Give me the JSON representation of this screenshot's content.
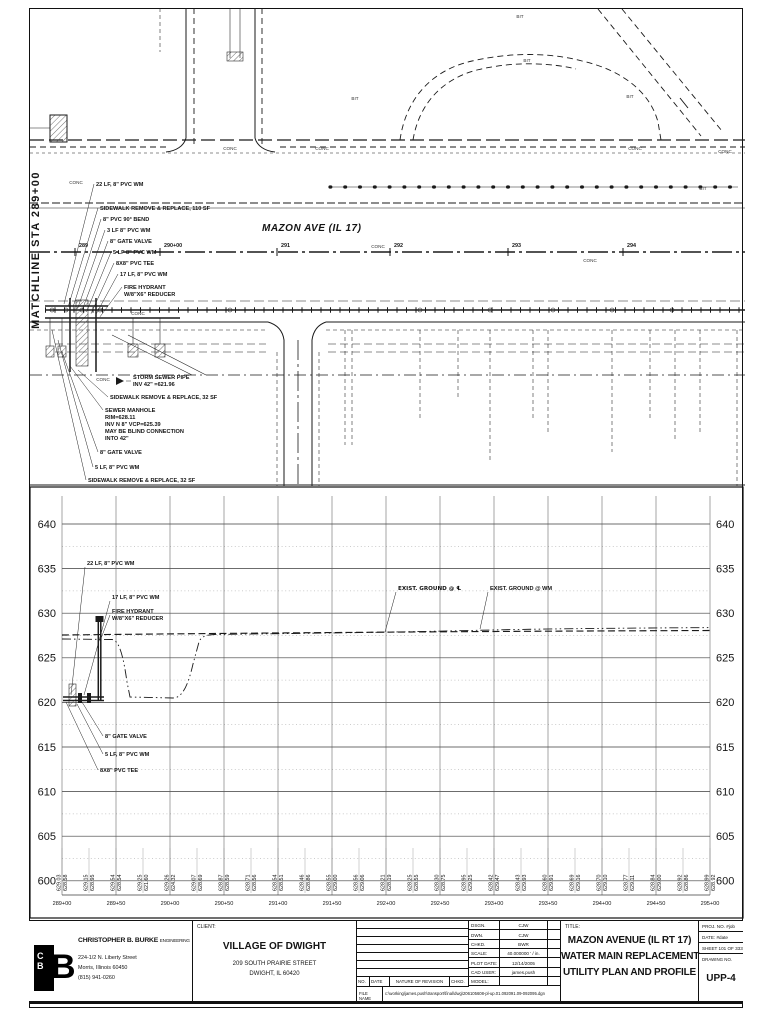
{
  "labels": {
    "conc": "CONC",
    "bit": "BIT"
  },
  "plan": {
    "matchline": "MATCHLINE STA 289+00",
    "road_name": "MAZON AVE (IL 17)",
    "stations": [
      "289",
      "290+00",
      "291",
      "292",
      "293",
      "294"
    ],
    "callouts_upper": [
      "22 LF, 8\" PVC WM",
      "SIDEWALK REMOVE & REPLACE, 110 SF",
      "8\" PVC 90° BEND",
      "3 LF 8\" PVC WM",
      "8\" GATE VALVE",
      "5 LF 8\" PVC WM",
      "8X8\" PVC TEE",
      "17 LF, 8\" PVC WM",
      [
        "FIRE HYDRANT",
        "W/8\"X6\" REDUCER"
      ]
    ],
    "callouts_lower": [
      [
        "STORM SEWER PIPE",
        "INV 42\" =621.96"
      ],
      "SIDEWALK REMOVE & REPLACE, 32 SF",
      [
        "SEWER MANHOLE",
        "RIM=628.11",
        "INV N 8\" VCP=625.39",
        "MAY BE BLIND CONNECTION",
        "INTO 42\""
      ],
      "8\" GATE VALVE",
      "5 LF, 8\" PVC WM",
      "SIDEWALK REMOVE & REPLACE, 32 SF"
    ]
  },
  "profile": {
    "elevations": [
      "640",
      "635",
      "630",
      "625",
      "620",
      "615",
      "610",
      "605",
      "600"
    ],
    "stations": [
      "289+00",
      "289+50",
      "290+00",
      "290+50",
      "291+00",
      "291+50",
      "292+00",
      "292+50",
      "293+00",
      "293+50",
      "294+00",
      "294+50",
      "295+00"
    ],
    "ground_cl": "EXIST. GROUND @ ℄",
    "ground_wm": "EXIST. GROUND @ WM",
    "callouts": [
      "22 LF, 8\" PVC WM",
      "17 LF, 8\" PVC WM",
      [
        "FIRE HYDRANT",
        "W/8\"X6\" REDUCER"
      ],
      "8\" GATE VALVE",
      "5 LF, 8\" PVC WM",
      "8X8\" PVC TEE"
    ],
    "elevation_pairs": [
      [
        "629.03",
        "628.58"
      ],
      [
        "629.15",
        "628.95"
      ],
      [
        "629.54",
        "628.54"
      ],
      [
        "629.25",
        "621.60"
      ],
      [
        "629.26",
        "624.32"
      ],
      [
        "629.07",
        "628.69"
      ],
      [
        "628.87",
        "628.59"
      ],
      [
        "628.71",
        "628.56"
      ],
      [
        "628.54",
        "628.51"
      ],
      [
        "628.46",
        "628.86"
      ],
      [
        "628.55",
        "629.00"
      ],
      [
        "628.56",
        "629.06"
      ],
      [
        "628.21",
        "628.19"
      ],
      [
        "628.25",
        "628.55"
      ],
      [
        "628.30",
        "628.75"
      ],
      [
        "628.95",
        "629.25"
      ],
      [
        "628.42",
        "629.47"
      ],
      [
        "628.43",
        "629.93"
      ],
      [
        "628.60",
        "629.91"
      ],
      [
        "628.69",
        "629.16"
      ],
      [
        "628.70",
        "629.10"
      ],
      [
        "628.77",
        "629.11"
      ],
      [
        "628.84",
        "629.00"
      ],
      [
        "628.92",
        "628.86"
      ],
      [
        "628.99",
        "628.92"
      ]
    ]
  },
  "titleblock": {
    "company": {
      "name": "CHRISTOPHER B. BURKE",
      "suffix": "ENGINEERING LTD.",
      "address1": "224-1/2 N. Liberty Street",
      "address2": "Morris, Illinois 60450",
      "phone": "(815) 941-0260",
      "logo_c": "C",
      "logo_b": "B",
      "logo_big_b": "B"
    },
    "client": {
      "label": "CLIENT:",
      "name": "VILLAGE OF DWIGHT",
      "address1": "209 SOUTH PRAIRIE STREET",
      "address2": "DWIGHT, IL 60420"
    },
    "revision": {
      "no": "NO.",
      "date": "DATE",
      "nature": "NATURE OF REVISION",
      "chkd": "CHKD.",
      "file_label": "FILE NAME",
      "file_path": "c:\\working\\james.push\\transport\\final\\dwg\\206105608-pl-up.01.092091.09-092095.dgn"
    },
    "info": {
      "dsgn_label": "DSGN.",
      "dsgn": "CJW",
      "dwn_label": "DWN.",
      "dwn": "CJW",
      "chkd_label": "CHKD.",
      "chkd": "BWR",
      "scale_label": "SCALE:",
      "scale": "40.000000 ' / in.",
      "plot_label": "PLOT DATE:",
      "plot": "12/14/2005",
      "cad_label": "CAD USER:",
      "cad": "james.push",
      "model_label": "MODEL:"
    },
    "title": {
      "label": "TITLE:",
      "lines": [
        "MAZON AVENUE (IL RT 17)",
        "WATER MAIN REPLACEMENT",
        "UTILITY PLAN AND PROFILE"
      ]
    },
    "meta": {
      "proj_label": "PROJ. NO.",
      "proj": "#job",
      "date_label": "DATE:",
      "date": "#date",
      "sheet_label": "SHEET",
      "sheet": "101 OF 333",
      "drawing_label": "DRAWING NO.",
      "drawing_no": "UPP-4"
    }
  }
}
